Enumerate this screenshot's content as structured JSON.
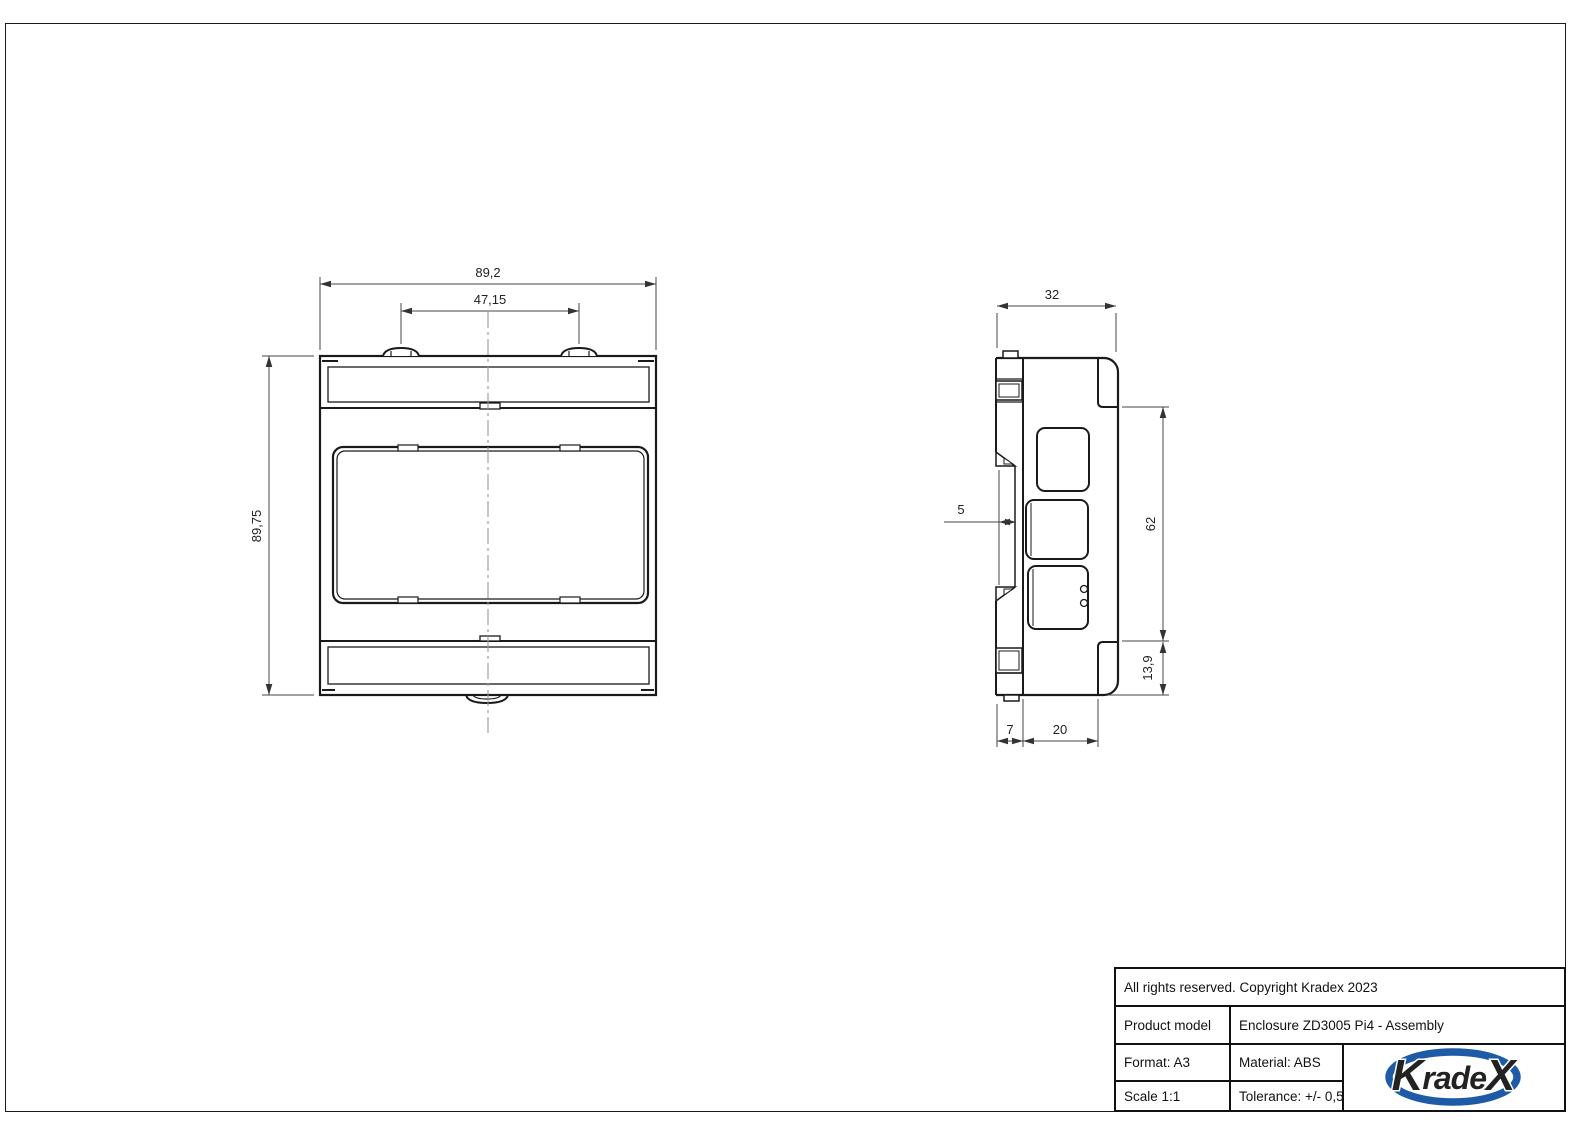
{
  "sheet": {
    "background": "#ffffff",
    "line_color": "#1a1a1a"
  },
  "front_view": {
    "dim_width": "89,2",
    "dim_mount_spacing": "47,15",
    "dim_height": "89,75"
  },
  "side_view": {
    "dim_depth": "32",
    "dim_rail_offset": "5",
    "dim_body_height": "62",
    "dim_lower_height": "13,9",
    "dim_clip_depth": "7",
    "dim_cover_depth": "20"
  },
  "title_block": {
    "copyright": "All rights reserved. Copyright Kradex 2023",
    "product_model_label": "Product model",
    "product_model_value": "Enclosure ZD3005 Pi4 - Assembly",
    "format": "Format: A3",
    "material": "Material: ABS",
    "scale": "Scale 1:1",
    "tolerance": "Tolerance: +/- 0,5",
    "logo": {
      "k": "K",
      "mid": "rade",
      "x": "X",
      "color": "#1d5ba6"
    }
  }
}
